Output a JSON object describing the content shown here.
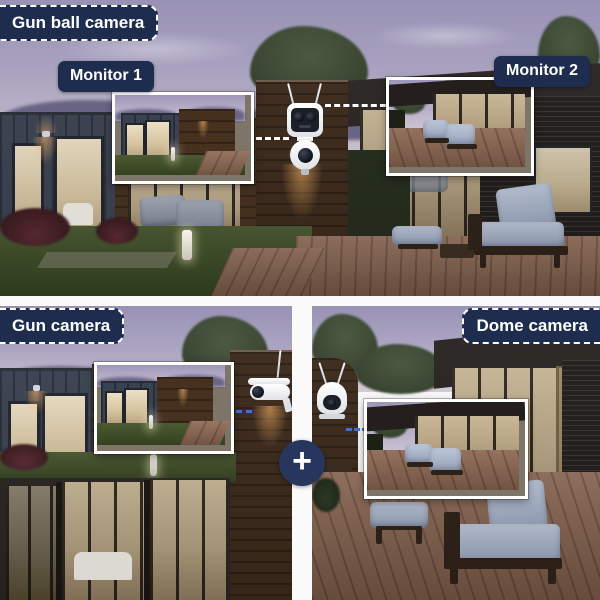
{
  "top_panel": {
    "tag": "Gun ball camera",
    "monitor1_label": "Monitor 1",
    "monitor2_label": "Monitor 2"
  },
  "bottom_left_panel": {
    "tag": "Gun camera"
  },
  "bottom_right_panel": {
    "tag": "Dome camera"
  },
  "combiner": {
    "plus_symbol": "+"
  },
  "icons": {
    "top_camera": "dual-lens-gun-ball-camera",
    "bottom_left_camera": "bullet-gun-camera",
    "bottom_right_camera": "ptz-dome-camera"
  },
  "colors": {
    "label_bg": "#1e2c4e",
    "label_text": "#ffffff",
    "frame_border": "#ffffff",
    "connector_top": "#ffffff",
    "connector_bottom": "#3f6fd8",
    "divider": "#fafafa",
    "plus_circle_bg": "#26365c"
  }
}
